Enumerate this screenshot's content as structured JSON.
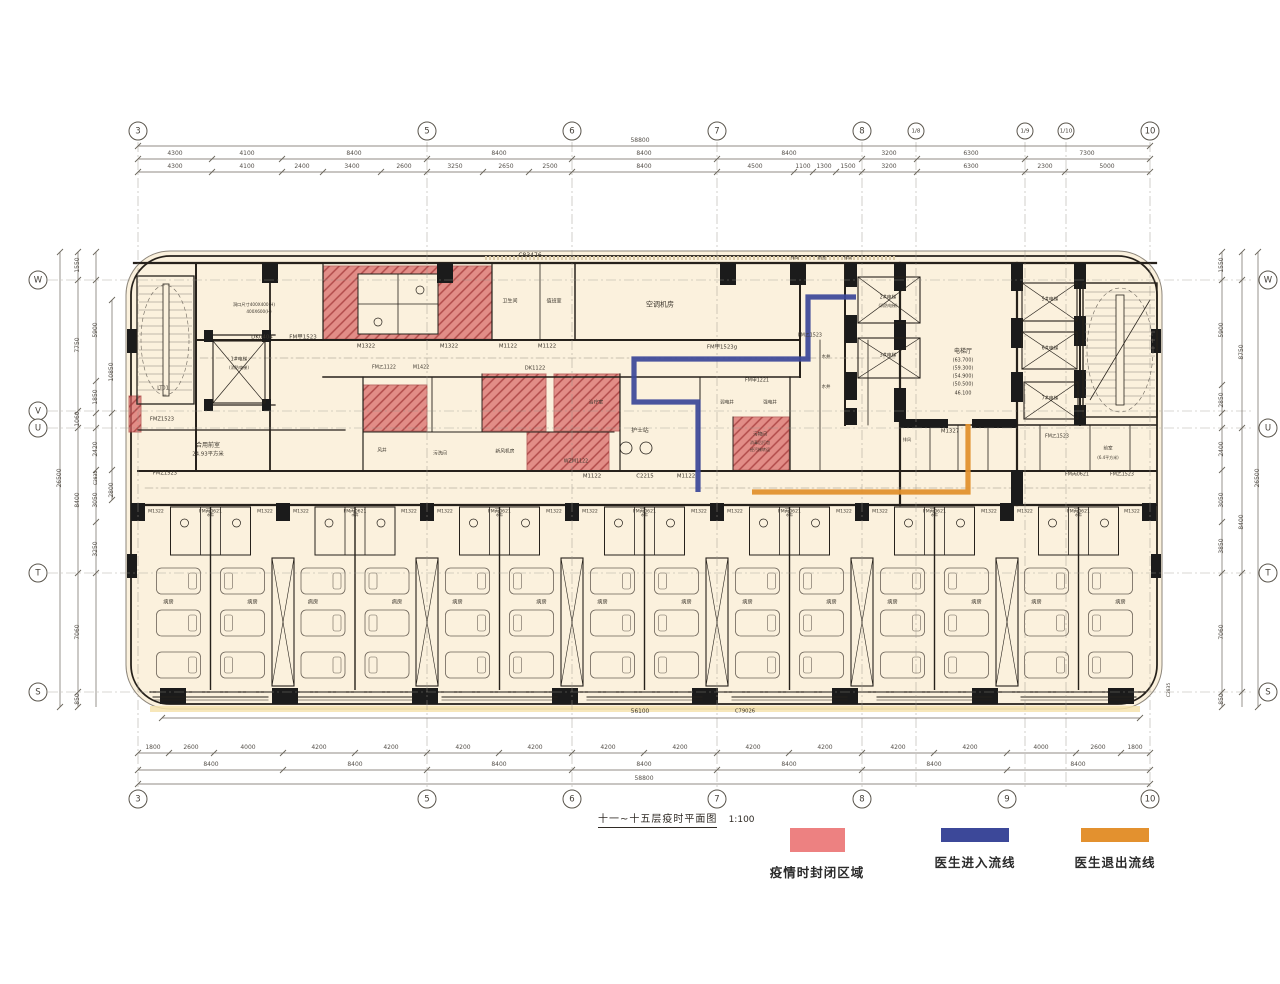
{
  "title": {
    "text": "十一~十五层疫时平面图",
    "scale": "1:100"
  },
  "legend": {
    "items": [
      {
        "label": "疫情时封闭区域",
        "color": "#ED8181",
        "swatch_w": 55,
        "swatch_h": 24,
        "cx": 817
      },
      {
        "label": "医生进入流线",
        "color": "#3C4899",
        "swatch_w": 68,
        "swatch_h": 14,
        "cx": 975
      },
      {
        "label": "医生退出流线",
        "color": "#E3912F",
        "swatch_w": 68,
        "swatch_h": 14,
        "cx": 1115
      }
    ]
  },
  "colors": {
    "floor": "#FBF1DD",
    "wall": "#26211B",
    "closed_zone": "#D96767",
    "zone_hatch": "#A83F3F",
    "entry_flow": "#3C4899",
    "exit_flow": "#E2912E",
    "dim": "#6b655c",
    "grid": "#9a958c",
    "tread": "#8a8178",
    "accent_strip": "#F6E3AE"
  },
  "grid": {
    "top_y": 131,
    "bottom_y": 799,
    "left_x": 38,
    "right_x": 1268,
    "top": [
      {
        "l": "3",
        "x": 138
      },
      {
        "l": "5",
        "x": 427
      },
      {
        "l": "6",
        "x": 572
      },
      {
        "l": "7",
        "x": 717
      },
      {
        "l": "8",
        "x": 862
      },
      {
        "l": "1/8",
        "x": 916,
        "s": 1
      },
      {
        "l": "1/9",
        "x": 1025,
        "s": 1
      },
      {
        "l": "1/10",
        "x": 1066,
        "s": 1
      },
      {
        "l": "10",
        "x": 1150
      }
    ],
    "bottom": [
      {
        "l": "3",
        "x": 138
      },
      {
        "l": "5",
        "x": 427
      },
      {
        "l": "6",
        "x": 572
      },
      {
        "l": "7",
        "x": 717
      },
      {
        "l": "8",
        "x": 862
      },
      {
        "l": "9",
        "x": 1007
      },
      {
        "l": "10",
        "x": 1150
      }
    ],
    "left": [
      {
        "l": "W",
        "y": 280
      },
      {
        "l": "V",
        "y": 411
      },
      {
        "l": "U",
        "y": 428
      },
      {
        "l": "T",
        "y": 573
      },
      {
        "l": "S",
        "y": 692
      }
    ],
    "right": [
      {
        "l": "W",
        "y": 280
      },
      {
        "l": "U",
        "y": 428
      },
      {
        "l": "T",
        "y": 573
      },
      {
        "l": "S",
        "y": 692
      }
    ]
  },
  "dim_lines": {
    "h": [
      {
        "y": 146,
        "x1": 138,
        "x2": 1150,
        "t": [
          138,
          1150
        ]
      },
      {
        "y": 159,
        "x1": 138,
        "x2": 1150,
        "t": [
          138,
          212,
          282,
          427,
          572,
          717,
          862,
          917,
          1025,
          1150
        ]
      },
      {
        "y": 172,
        "x1": 138,
        "x2": 1150,
        "t": [
          138,
          212,
          282,
          323,
          381,
          427,
          483,
          529,
          572,
          717,
          794,
          813,
          836,
          862,
          917,
          1025,
          1065,
          1150
        ]
      },
      {
        "y": 718,
        "x1": 162,
        "x2": 1140,
        "t": [
          162,
          1140
        ]
      },
      {
        "y": 753,
        "x1": 138,
        "x2": 1150,
        "t": [
          138,
          169,
          214,
          283,
          355,
          427,
          499,
          572,
          644,
          717,
          789,
          862,
          934,
          1007,
          1076,
          1121,
          1150
        ]
      },
      {
        "y": 770,
        "x1": 138,
        "x2": 1150,
        "t": [
          138,
          283,
          427,
          572,
          717,
          862,
          1007,
          1150
        ]
      },
      {
        "y": 784,
        "x1": 138,
        "x2": 1150,
        "t": [
          138,
          1150
        ]
      }
    ],
    "v": [
      {
        "x": 60,
        "y1": 252,
        "y2": 707,
        "t": [
          252,
          707
        ]
      },
      {
        "x": 78,
        "y1": 252,
        "y2": 707,
        "t": [
          252,
          280,
          411,
          428,
          573,
          692,
          707
        ]
      },
      {
        "x": 96,
        "y1": 252,
        "y2": 707,
        "t": [
          252,
          280,
          381,
          413,
          428,
          470,
          522,
          573
        ]
      },
      {
        "x": 112,
        "y1": 300,
        "y2": 500,
        "t": [
          300,
          413,
          470,
          500
        ]
      },
      {
        "x": 1222,
        "y1": 252,
        "y2": 707,
        "t": [
          252,
          280,
          385,
          413,
          428,
          470,
          522,
          573,
          692,
          707
        ]
      },
      {
        "x": 1242,
        "y1": 252,
        "y2": 707,
        "t": [
          252,
          280,
          428,
          573,
          692
        ]
      },
      {
        "x": 1258,
        "y1": 252,
        "y2": 707,
        "t": [
          252,
          707
        ]
      }
    ]
  },
  "dim_labels": [
    {
      "t": "58800",
      "x": 640,
      "y": 141
    },
    {
      "t": "4300",
      "x": 175,
      "y": 154
    },
    {
      "t": "4100",
      "x": 247,
      "y": 154
    },
    {
      "t": "8400",
      "x": 354,
      "y": 154
    },
    {
      "t": "8400",
      "x": 499,
      "y": 154
    },
    {
      "t": "8400",
      "x": 644,
      "y": 154
    },
    {
      "t": "8400",
      "x": 789,
      "y": 154
    },
    {
      "t": "3200",
      "x": 889,
      "y": 154
    },
    {
      "t": "6300",
      "x": 971,
      "y": 154
    },
    {
      "t": "7300",
      "x": 1087,
      "y": 154
    },
    {
      "t": "4300",
      "x": 175,
      "y": 167
    },
    {
      "t": "4100",
      "x": 247,
      "y": 167
    },
    {
      "t": "2400",
      "x": 302,
      "y": 167
    },
    {
      "t": "3400",
      "x": 352,
      "y": 167
    },
    {
      "t": "2600",
      "x": 404,
      "y": 167
    },
    {
      "t": "3250",
      "x": 455,
      "y": 167
    },
    {
      "t": "2650",
      "x": 506,
      "y": 167
    },
    {
      "t": "2500",
      "x": 550,
      "y": 167
    },
    {
      "t": "8400",
      "x": 644,
      "y": 167
    },
    {
      "t": "4500",
      "x": 755,
      "y": 167
    },
    {
      "t": "1100",
      "x": 803,
      "y": 167
    },
    {
      "t": "1300",
      "x": 824,
      "y": 167
    },
    {
      "t": "1500",
      "x": 848,
      "y": 167
    },
    {
      "t": "3200",
      "x": 889,
      "y": 167
    },
    {
      "t": "6300",
      "x": 971,
      "y": 167
    },
    {
      "t": "2300",
      "x": 1045,
      "y": 167
    },
    {
      "t": "5000",
      "x": 1107,
      "y": 167
    },
    {
      "t": "1800",
      "x": 153,
      "y": 748
    },
    {
      "t": "2600",
      "x": 191,
      "y": 748
    },
    {
      "t": "4000",
      "x": 248,
      "y": 748
    },
    {
      "t": "4200",
      "x": 319,
      "y": 748
    },
    {
      "t": "4200",
      "x": 391,
      "y": 748
    },
    {
      "t": "4200",
      "x": 463,
      "y": 748
    },
    {
      "t": "4200",
      "x": 535,
      "y": 748
    },
    {
      "t": "4200",
      "x": 608,
      "y": 748
    },
    {
      "t": "4200",
      "x": 680,
      "y": 748
    },
    {
      "t": "4200",
      "x": 753,
      "y": 748
    },
    {
      "t": "4200",
      "x": 825,
      "y": 748
    },
    {
      "t": "4200",
      "x": 898,
      "y": 748
    },
    {
      "t": "4200",
      "x": 970,
      "y": 748
    },
    {
      "t": "4000",
      "x": 1041,
      "y": 748
    },
    {
      "t": "2600",
      "x": 1098,
      "y": 748
    },
    {
      "t": "1800",
      "x": 1135,
      "y": 748
    },
    {
      "t": "8400",
      "x": 211,
      "y": 765
    },
    {
      "t": "8400",
      "x": 355,
      "y": 765
    },
    {
      "t": "8400",
      "x": 499,
      "y": 765
    },
    {
      "t": "8400",
      "x": 644,
      "y": 765
    },
    {
      "t": "8400",
      "x": 789,
      "y": 765
    },
    {
      "t": "8400",
      "x": 934,
      "y": 765
    },
    {
      "t": "8400",
      "x": 1078,
      "y": 765
    },
    {
      "t": "58800",
      "x": 644,
      "y": 779
    },
    {
      "t": "26500",
      "x": 60,
      "y": 478,
      "r": 1
    },
    {
      "t": "1550",
      "x": 78,
      "y": 265,
      "r": 1
    },
    {
      "t": "7750",
      "x": 78,
      "y": 345,
      "r": 1
    },
    {
      "t": "1060",
      "x": 78,
      "y": 419,
      "r": 1
    },
    {
      "t": "8400",
      "x": 78,
      "y": 500,
      "r": 1
    },
    {
      "t": "7060",
      "x": 78,
      "y": 632,
      "r": 1
    },
    {
      "t": "850",
      "x": 78,
      "y": 699,
      "r": 1
    },
    {
      "t": "5900",
      "x": 96,
      "y": 330,
      "r": 1
    },
    {
      "t": "1850",
      "x": 96,
      "y": 397,
      "r": 1
    },
    {
      "t": "2420",
      "x": 96,
      "y": 449,
      "r": 1
    },
    {
      "t": "3050",
      "x": 96,
      "y": 500,
      "r": 1
    },
    {
      "t": "3250",
      "x": 96,
      "y": 549,
      "r": 1
    },
    {
      "t": "10850",
      "x": 112,
      "y": 372,
      "r": 1
    },
    {
      "t": "2800",
      "x": 112,
      "y": 490,
      "r": 1
    },
    {
      "t": "1550",
      "x": 1222,
      "y": 265,
      "r": 1
    },
    {
      "t": "5900",
      "x": 1222,
      "y": 330,
      "r": 1
    },
    {
      "t": "2850",
      "x": 1222,
      "y": 400,
      "r": 1
    },
    {
      "t": "2400",
      "x": 1222,
      "y": 449,
      "r": 1
    },
    {
      "t": "3050",
      "x": 1222,
      "y": 500,
      "r": 1
    },
    {
      "t": "3850",
      "x": 1222,
      "y": 546,
      "r": 1
    },
    {
      "t": "7060",
      "x": 1222,
      "y": 632,
      "r": 1
    },
    {
      "t": "850",
      "x": 1222,
      "y": 699,
      "r": 1
    },
    {
      "t": "8750",
      "x": 1242,
      "y": 352,
      "r": 1
    },
    {
      "t": "8400",
      "x": 1242,
      "y": 522,
      "r": 1
    },
    {
      "t": "26500",
      "x": 1258,
      "y": 478,
      "r": 1
    }
  ],
  "labels": [
    {
      "t": "C83476",
      "x": 530,
      "y": 256,
      "s": 6
    },
    {
      "t": "DK0404",
      "x": 262,
      "y": 338,
      "s": 5.5
    },
    {
      "t": "FM甲1523",
      "x": 303,
      "y": 338,
      "s": 5.5
    },
    {
      "t": "洞口尺寸400X400(H)",
      "x": 254,
      "y": 305,
      "s": 4.2
    },
    {
      "t": "400X600(H)",
      "x": 259,
      "y": 312,
      "s": 4.2
    },
    {
      "t": "1#电梯",
      "x": 239,
      "y": 361,
      "s": 4.8
    },
    {
      "t": "(消防电梯)",
      "x": 239,
      "y": 368,
      "s": 4.2
    },
    {
      "t": "LT01",
      "x": 163,
      "y": 389,
      "s": 5
    },
    {
      "t": "FMZ1523",
      "x": 162,
      "y": 420,
      "s": 5.2
    },
    {
      "t": "FMZ1523",
      "x": 165,
      "y": 474,
      "s": 5.2
    },
    {
      "t": "合用前室",
      "x": 208,
      "y": 446,
      "s": 6
    },
    {
      "t": "24.93平方米",
      "x": 208,
      "y": 455,
      "s": 5.4
    },
    {
      "t": "M1322",
      "x": 366,
      "y": 347,
      "s": 5.4
    },
    {
      "t": "M1322",
      "x": 449,
      "y": 347,
      "s": 5.4
    },
    {
      "t": "M1122",
      "x": 508,
      "y": 347,
      "s": 5.4
    },
    {
      "t": "M1122",
      "x": 547,
      "y": 347,
      "s": 5.4
    },
    {
      "t": "FM乙1122",
      "x": 384,
      "y": 369,
      "s": 4.8
    },
    {
      "t": "M1422",
      "x": 421,
      "y": 369,
      "s": 4.8
    },
    {
      "t": "DK1122",
      "x": 535,
      "y": 369,
      "s": 5.2
    },
    {
      "t": "卫生间",
      "x": 510,
      "y": 302,
      "s": 5
    },
    {
      "t": "值班室",
      "x": 554,
      "y": 302,
      "s": 5
    },
    {
      "t": "空调机房",
      "x": 660,
      "y": 305,
      "s": 7
    },
    {
      "t": "FM甲1523g",
      "x": 722,
      "y": 348,
      "s": 5.4
    },
    {
      "t": "FM乙1523",
      "x": 810,
      "y": 337,
      "s": 4.8
    },
    {
      "t": "FM甲1221",
      "x": 757,
      "y": 382,
      "s": 4.8
    },
    {
      "t": "弱电井",
      "x": 727,
      "y": 404,
      "s": 4.6
    },
    {
      "t": "强电井",
      "x": 770,
      "y": 404,
      "s": 4.6
    },
    {
      "t": "治疗室",
      "x": 596,
      "y": 404,
      "s": 4.8
    },
    {
      "t": "护士站",
      "x": 640,
      "y": 432,
      "s": 5.8
    },
    {
      "t": "M1122",
      "x": 592,
      "y": 477,
      "s": 5.4
    },
    {
      "t": "C2215",
      "x": 645,
      "y": 477,
      "s": 5.4
    },
    {
      "t": "M1122",
      "x": 686,
      "y": 477,
      "s": 5.4
    },
    {
      "t": "风井",
      "x": 382,
      "y": 452,
      "s": 4.6
    },
    {
      "t": "污洗间",
      "x": 440,
      "y": 455,
      "s": 4.6
    },
    {
      "t": "新风机房",
      "x": 505,
      "y": 453,
      "s": 4.8
    },
    {
      "t": "WZM1122",
      "x": 576,
      "y": 463,
      "s": 4.8
    },
    {
      "t": "污物间",
      "x": 760,
      "y": 436,
      "s": 4.6
    },
    {
      "t": "消毒后打包",
      "x": 760,
      "y": 443,
      "s": 4
    },
    {
      "t": "经污梯转运",
      "x": 760,
      "y": 450,
      "s": 4
    },
    {
      "t": "水井",
      "x": 826,
      "y": 358,
      "s": 4.4
    },
    {
      "t": "水井",
      "x": 826,
      "y": 388,
      "s": 4.4
    },
    {
      "t": "排风",
      "x": 795,
      "y": 258,
      "s": 4.2
    },
    {
      "t": "前室",
      "x": 822,
      "y": 258,
      "s": 4.2
    },
    {
      "t": "排风",
      "x": 848,
      "y": 258,
      "s": 4.2
    },
    {
      "t": "2#电梯",
      "x": 888,
      "y": 299,
      "s": 4.8
    },
    {
      "t": "(消防电梯)",
      "x": 888,
      "y": 306,
      "s": 4
    },
    {
      "t": "3#电梯",
      "x": 888,
      "y": 357,
      "s": 4.8
    },
    {
      "t": "电梯厅",
      "x": 963,
      "y": 352,
      "s": 6
    },
    {
      "t": "(63.700)",
      "x": 963,
      "y": 362,
      "s": 4.8
    },
    {
      "t": "(59.300)",
      "x": 963,
      "y": 370,
      "s": 4.8
    },
    {
      "t": "(54.900)",
      "x": 963,
      "y": 378,
      "s": 4.8
    },
    {
      "t": "(50.500)",
      "x": 963,
      "y": 386,
      "s": 4.8
    },
    {
      "t": "46.100",
      "x": 963,
      "y": 395,
      "s": 4.8
    },
    {
      "t": "5#电梯",
      "x": 1050,
      "y": 301,
      "s": 4.8
    },
    {
      "t": "6#电梯",
      "x": 1050,
      "y": 350,
      "s": 4.8
    },
    {
      "t": "7#电梯",
      "x": 1050,
      "y": 400,
      "s": 4.8
    },
    {
      "t": "M1327",
      "x": 950,
      "y": 432,
      "s": 5.4
    },
    {
      "t": "排风",
      "x": 907,
      "y": 440,
      "s": 4.2
    },
    {
      "t": "FM乙1523",
      "x": 1057,
      "y": 438,
      "s": 4.8
    },
    {
      "t": "前室",
      "x": 1108,
      "y": 450,
      "s": 4.6
    },
    {
      "t": "(6.4平方米)",
      "x": 1108,
      "y": 458,
      "s": 4
    },
    {
      "t": "FM丙0621",
      "x": 1077,
      "y": 476,
      "s": 4.8
    },
    {
      "t": "FM乙1523",
      "x": 1122,
      "y": 476,
      "s": 4.8
    },
    {
      "t": "C2835",
      "x": 97,
      "y": 478,
      "s": 4.4,
      "r": 1
    },
    {
      "t": "C2835",
      "x": 1170,
      "y": 690,
      "s": 4.4,
      "r": 1
    },
    {
      "t": "56100",
      "x": 640,
      "y": 713,
      "s": 5.8
    },
    {
      "t": "C79026",
      "x": 745,
      "y": 712,
      "s": 5.2
    }
  ],
  "zones": [
    {
      "x": 323,
      "y": 266,
      "w": 169,
      "h": 73
    },
    {
      "x": 363,
      "y": 385,
      "w": 64,
      "h": 46
    },
    {
      "x": 482,
      "y": 374,
      "w": 64,
      "h": 57
    },
    {
      "x": 554,
      "y": 374,
      "w": 66,
      "h": 57
    },
    {
      "x": 527,
      "y": 432,
      "w": 82,
      "h": 39
    },
    {
      "x": 733,
      "y": 417,
      "w": 56,
      "h": 53
    },
    {
      "x": 129,
      "y": 396,
      "w": 12,
      "h": 36
    }
  ],
  "zone_cutouts": [
    {
      "x": 358,
      "y": 274,
      "w": 80,
      "h": 60
    }
  ],
  "flows": {
    "entry": {
      "points": [
        [
          856,
          297
        ],
        [
          808,
          297
        ],
        [
          808,
          359
        ],
        [
          634,
          359
        ],
        [
          634,
          402
        ],
        [
          698,
          402
        ],
        [
          698,
          492
        ]
      ]
    },
    "exit": {
      "points": [
        [
          968,
          424
        ],
        [
          968,
          492
        ],
        [
          752,
          492
        ]
      ]
    }
  },
  "ward": {
    "boundaries": [
      138,
      283,
      427,
      572,
      717,
      862,
      1007,
      1150
    ],
    "room_label": "病房",
    "door_label": "M1322",
    "center_door_label": "FM丙0621",
    "shaft_label": "水井",
    "bed_rows": [
      568,
      610,
      652
    ]
  }
}
